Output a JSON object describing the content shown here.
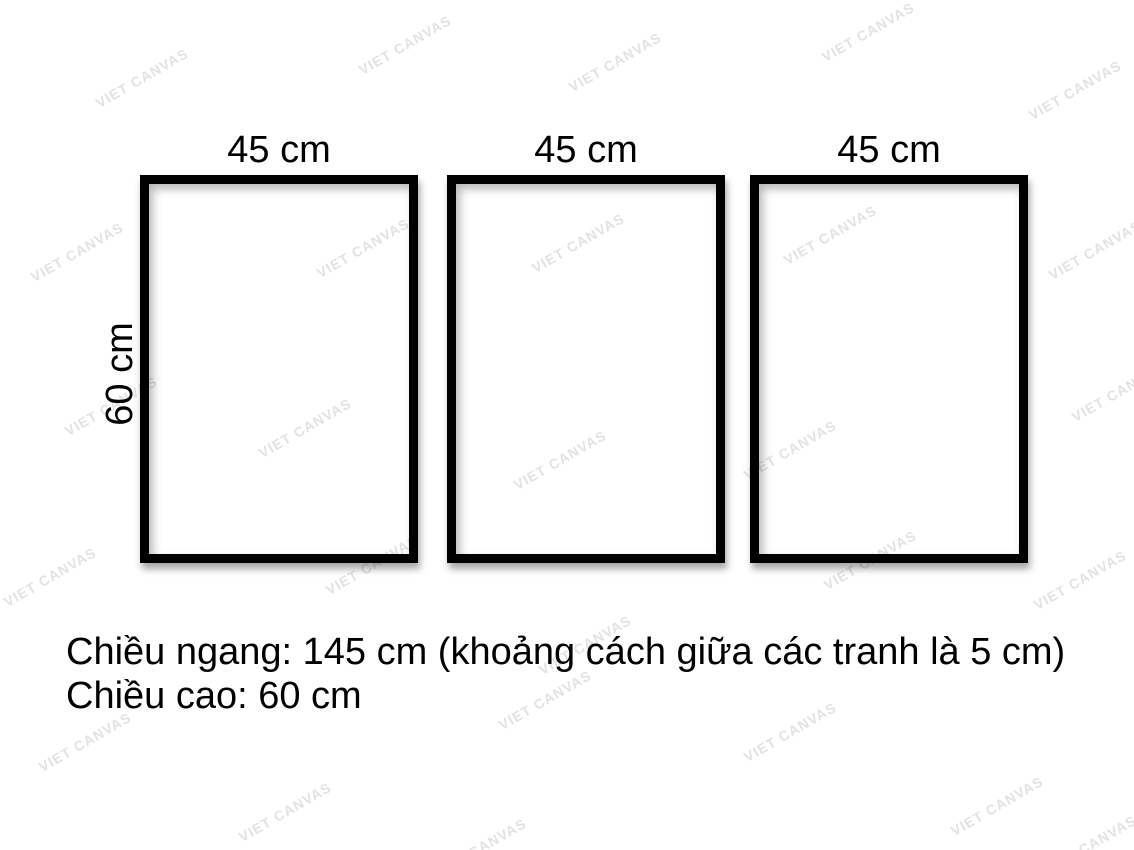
{
  "watermark": {
    "text": "VIET CANVAS"
  },
  "frames": [
    {
      "width_label": "45 cm"
    },
    {
      "width_label": "45 cm"
    },
    {
      "width_label": "45 cm"
    }
  ],
  "height_label": "60 cm",
  "caption": {
    "line1": "Chiều ngang: 145 cm (khoảng cách giữa các tranh là 5 cm)",
    "line2": "Chiều cao: 60 cm"
  },
  "colors": {
    "background": "#ffffff",
    "frame_border": "#000000",
    "label_text": "#000000",
    "watermark": "#e2e2e2"
  }
}
